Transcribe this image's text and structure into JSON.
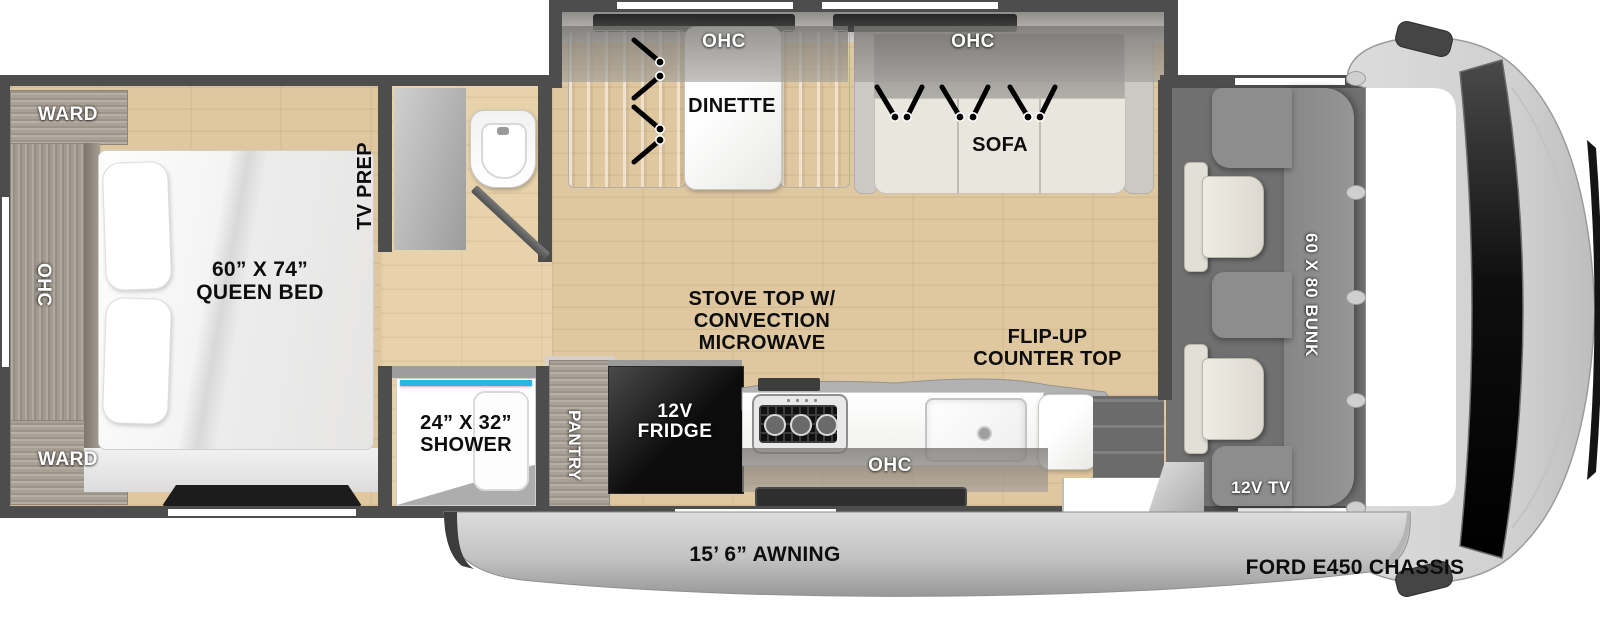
{
  "bedroom": {
    "ward_top": "WARD",
    "ohc": "OHC",
    "ward_bottom": "WARD",
    "bed_line1": "60” X 74”",
    "bed_line2": "QUEEN BED",
    "tv_prep": "TV PREP"
  },
  "shower": {
    "line1": "24” X 32”",
    "line2": "SHOWER"
  },
  "slideout": {
    "dinette_ohc": "OHC",
    "dinette": "DINETTE",
    "sofa_ohc": "OHC",
    "sofa": "SOFA"
  },
  "kitchen": {
    "pantry": "PANTRY",
    "fridge_line1": "12V",
    "fridge_line2": "FRIDGE",
    "stove_line1": "STOVE TOP W/",
    "stove_line2": "CONVECTION",
    "stove_line3": "MICROWAVE",
    "flip_line1": "FLIP-UP",
    "flip_line2": "COUNTER TOP",
    "ohc": "OHC"
  },
  "cab": {
    "bunk": "60 X 80 BUNK",
    "tv": "12V TV",
    "chassis": "FORD E450 CHASSIS"
  },
  "awning": {
    "label": "15’ 6” AWNING"
  },
  "colors": {
    "wall": "#4d4d4d",
    "floor_wood": "#dfc7a0",
    "cabinet_wood": "#a9a196",
    "shower_glass": "#2ab5e9",
    "fridge": "#111111",
    "bunk": "#8d8d8d",
    "awning_silver": "#c2c2c2"
  }
}
